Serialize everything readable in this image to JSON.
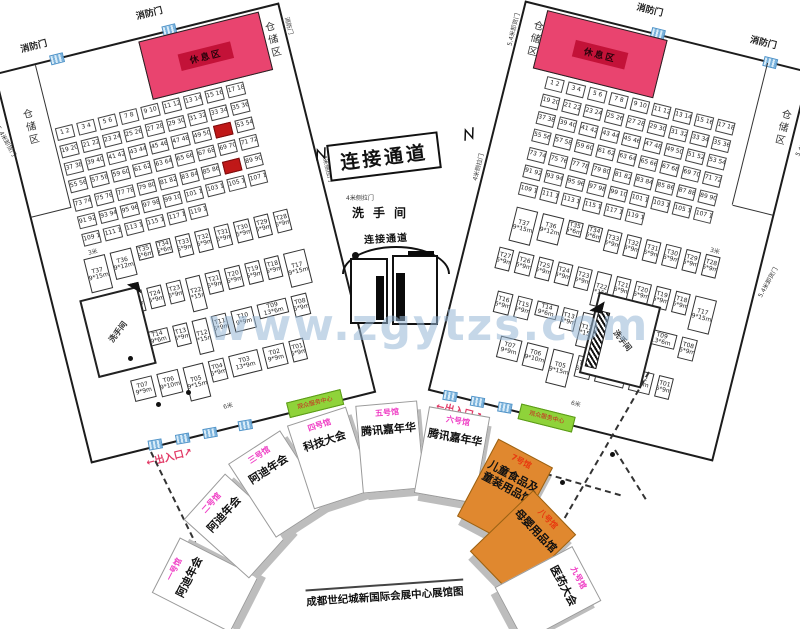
{
  "watermark": "www.zgytzs.com",
  "labels": {
    "fire_door": "消防门",
    "rest_area": "休息区",
    "storage": "仓储区",
    "unload_door": "5.4米卸货门",
    "side_door": "4米侧拉门",
    "entrance": "←出入口↗",
    "service_box": "观众服务中心",
    "corridor_banner": "连接通道",
    "corridor_small": "连接通道",
    "restroom": "洗手间",
    "outer_restroom": "洗手间",
    "aisle_3m": "3米",
    "aisle_6m": "6米"
  },
  "halls": {
    "small_booths": [
      "1 2",
      "3 4",
      "5 6",
      "7 8",
      "9 10",
      "11 12",
      "13 14",
      "15 16",
      "17 18",
      "19 20",
      "21 22",
      "23 24",
      "25 26",
      "27 28",
      "29 30",
      "31 32",
      "33 34",
      "35 36",
      "37 38",
      "39 40",
      "41 42",
      "43 44",
      "45 46",
      "47 48",
      "49 50",
      "51 52",
      "53 54",
      "55 56",
      "57 58",
      "59 60",
      "61 62",
      "63 64",
      "65 66",
      "67 68",
      "69 70",
      "71 72",
      "73 74",
      "75 76",
      "77 78",
      "79 80",
      "81 82",
      "83 84",
      "85 86",
      "87 88",
      "89 90",
      "91 92",
      "93 94",
      "95 96",
      "97 98",
      "99 100",
      "101 102",
      "103 104",
      "105 106",
      "107 108",
      "109 110",
      "111 112",
      "113 114",
      "115 116",
      "117 118",
      "119 120"
    ],
    "red_booth_indices": [
      25,
      43
    ],
    "t_booths": [
      "T01 6*9m",
      "T02 9*9m",
      "T03 13*9m",
      "T04 6*9m",
      "T05 9*15m",
      "T06 9*10m",
      "T07 9*9m",
      "T08 6*9m",
      "T09 13*6m",
      "T10 9*9m",
      "T11 6*9m",
      "T12 6*15m",
      "T13 6*9m",
      "T14 9*6m",
      "T15 6*9m",
      "T16 6*9m",
      "T17 9*15m",
      "T18 6*9m",
      "T19 6*9m",
      "T20 6*9m",
      "T21 6*9m",
      "T22 6*15m",
      "T23 6*9m",
      "T24 6*9m",
      "T25 6*9m",
      "T26 6*9m",
      "T27 6*9m",
      "T28 6*9m",
      "T29 6*9m",
      "T30 6*9m",
      "T31 6*9m",
      "T32 6*9m",
      "T33 6*9m",
      "T34 6*6m",
      "T35 6*6m",
      "T36 9*12m",
      "T37 9*15m"
    ]
  },
  "fan": {
    "caption": "成都世纪城新国际会展中心展馆图",
    "halls": [
      {
        "name": "一号馆",
        "event": "阿迪年会",
        "color": "white"
      },
      {
        "name": "二号馆",
        "event": "阿迪年会",
        "color": "white"
      },
      {
        "name": "三号馆",
        "event": "阿迪年会",
        "color": "white"
      },
      {
        "name": "四号馆",
        "event": "科技大会",
        "color": "white"
      },
      {
        "name": "五号馆",
        "event": "腾讯嘉年华",
        "color": "white"
      },
      {
        "name": "六号馆",
        "event": "腾讯嘉年华",
        "color": "white"
      },
      {
        "name": "7号馆",
        "event": "儿童食品及童装用品馆",
        "color": "orange"
      },
      {
        "name": "八号馆",
        "event": "母婴用品馆",
        "color": "orange"
      },
      {
        "name": "九号馆",
        "event": "医药大会",
        "color": "white"
      }
    ]
  },
  "colors": {
    "rest_area": "#e9446f",
    "rest_band": "#c31238",
    "orange_hall": "#e0882f",
    "green_box": "#8fd33a",
    "hall_label_pink": "#ef3fc5",
    "hall7_label_red": "#e8390f",
    "entrance_red": "#e23a66",
    "door_blue": "#7ab2dc",
    "red_booth": "#c01818",
    "watermark_blue": "#96b6d6"
  }
}
